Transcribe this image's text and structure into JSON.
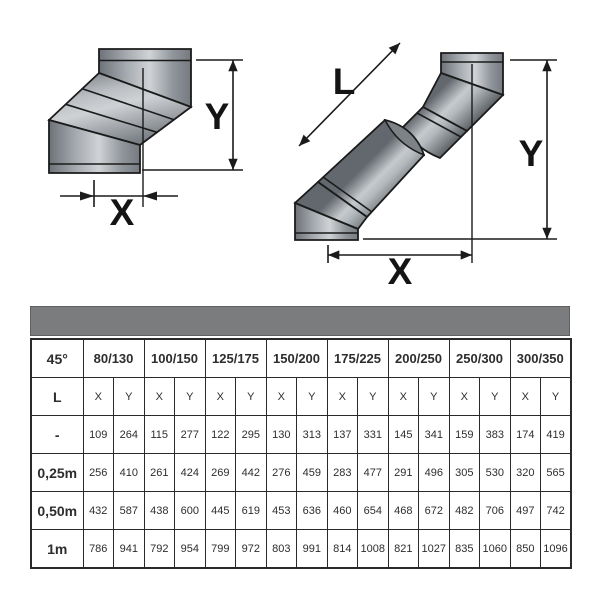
{
  "diagrams": {
    "left": {
      "x_label": "X",
      "y_label": "Y"
    },
    "right": {
      "x_label": "X",
      "y_label": "Y",
      "l_label": "L"
    }
  },
  "table": {
    "corner": "45°",
    "l_corner": "L",
    "sizes": [
      "80/130",
      "100/150",
      "125/175",
      "150/200",
      "175/225",
      "200/250",
      "250/300",
      "300/350"
    ],
    "subheaders": [
      "X",
      "Y",
      "X",
      "Y",
      "X",
      "Y",
      "X",
      "Y",
      "X",
      "Y",
      "X",
      "Y",
      "X",
      "Y",
      "X",
      "Y"
    ],
    "rows": [
      {
        "label": "-",
        "values": [
          "109",
          "264",
          "115",
          "277",
          "122",
          "295",
          "130",
          "313",
          "137",
          "331",
          "145",
          "341",
          "159",
          "383",
          "174",
          "419"
        ]
      },
      {
        "label": "0,25m",
        "values": [
          "256",
          "410",
          "261",
          "424",
          "269",
          "442",
          "276",
          "459",
          "283",
          "477",
          "291",
          "496",
          "305",
          "530",
          "320",
          "565"
        ]
      },
      {
        "label": "0,50m",
        "values": [
          "432",
          "587",
          "438",
          "600",
          "445",
          "619",
          "453",
          "636",
          "460",
          "654",
          "468",
          "672",
          "482",
          "706",
          "497",
          "742"
        ]
      },
      {
        "label": "1m",
        "values": [
          "786",
          "941",
          "792",
          "954",
          "799",
          "972",
          "803",
          "991",
          "814",
          "1008",
          "821",
          "1027",
          "835",
          "1060",
          "850",
          "1096"
        ]
      }
    ],
    "colors": {
      "band": "#7b7c7e",
      "label_col": "#d8d8d8",
      "border": "#2a2a2a"
    }
  }
}
